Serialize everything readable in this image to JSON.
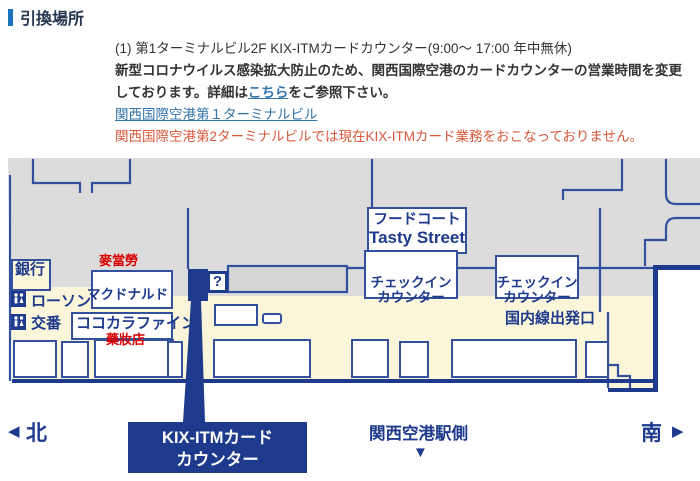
{
  "header": {
    "title": "引換場所",
    "accent_color": "#1b74c0"
  },
  "notice": {
    "line1": "(1) 第1ターミナルビル2F KIX-ITMカードカウンター(9:00～ 17:00 年中無休)",
    "covid_1": "新型コロナウイルス感染拡大防止のため、関西国際空港のカードカウンターの営業時間を変更",
    "covid_2_pre": "しております。詳細は",
    "covid_link_label": "こちら",
    "covid_2_post": "をご参照下さい。",
    "terminal_link_label": "関西国際空港第１ターミナルビル",
    "warning": "関西国際空港第2ターミナルビルでは現在KIX-ITMカード業務をおこなっておりません。",
    "link_color": "#3273ab",
    "warning_color": "#d9583b"
  },
  "map": {
    "labels": {
      "bank": "銀行",
      "lawson": "ローソン",
      "police_box": "交番",
      "cocokara_fine": "ココカラファイン",
      "mcdonalds": "マクドナルド",
      "mcdonalds_zh": "麥當勞",
      "drugstore_zh": "藥妝店",
      "food_court_line1": "フードコート",
      "food_court_line2": "Tasty Street",
      "checkin_line1": "チェックイン",
      "checkin_line2": "カウンター",
      "domestic_departure": "国内線出発口",
      "info_mark": "?"
    },
    "colors": {
      "terminal_gray": "#dcdcdc",
      "concourse_cream": "#fbf5da",
      "wall_blue": "#33509e",
      "marker_navy": "#1e3a8c",
      "label_red": "#d90000"
    }
  },
  "footer": {
    "north_arrow": "◀",
    "north_label": "北",
    "counter_line1": "KIX-ITMカード",
    "counter_line2": "カウンター",
    "station_side": "関西空港駅側",
    "station_arrow": "▼",
    "south_label": "南",
    "south_arrow": "▶"
  }
}
